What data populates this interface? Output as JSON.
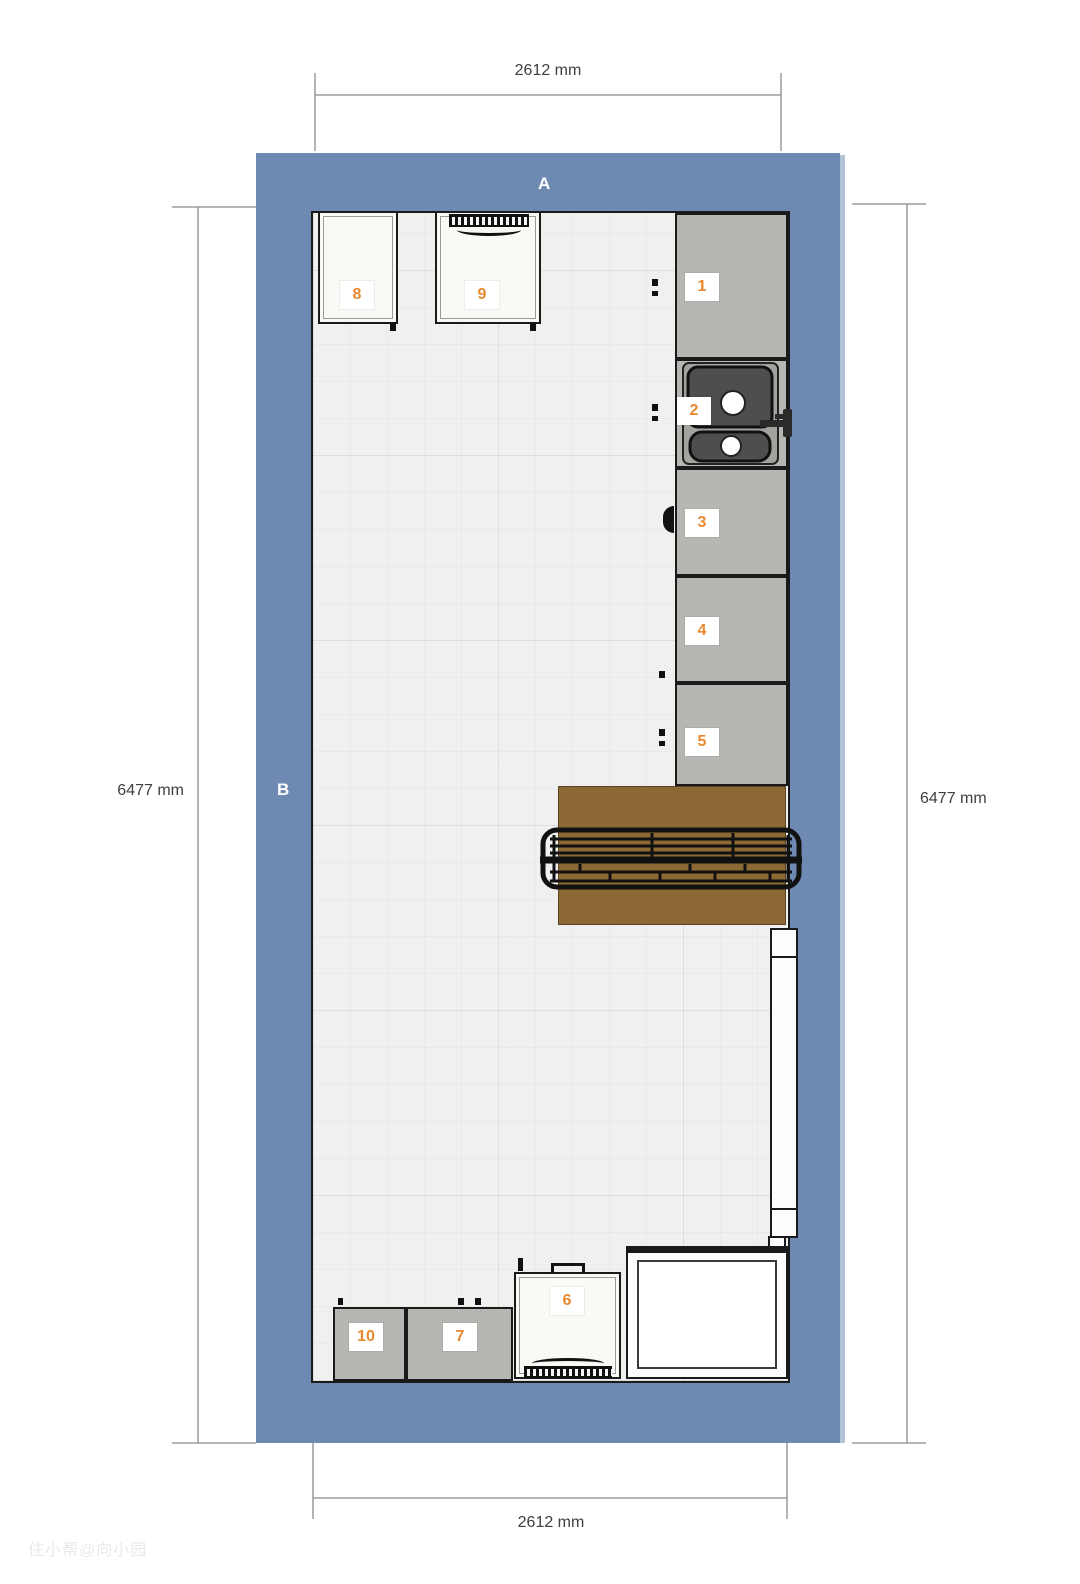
{
  "labels": {
    "a": "A",
    "b": "B"
  },
  "dimensions": {
    "top": "2612 mm",
    "bottom": "2612 mm",
    "left": "6477 mm",
    "right": "6477 mm"
  },
  "items": {
    "i1": "1",
    "i2": "2",
    "i3": "3",
    "i4": "4",
    "i5": "5",
    "i6": "6",
    "i7": "7",
    "i8": "8",
    "i9": "9",
    "i10": "10"
  },
  "watermark": "住小帮@向小园",
  "colors": {
    "wall": "#6e8ab2",
    "wall_highlight": "#b3c2d6",
    "floor": "#f0f0ee",
    "cabinet_gray": "#b6b6b2",
    "appliance_white": "#faf9f6",
    "table_wood": "#8c6934",
    "outline": "#1a1a1a",
    "label_orange": "#e8882f",
    "dimension_text": "#3f3f3f"
  }
}
